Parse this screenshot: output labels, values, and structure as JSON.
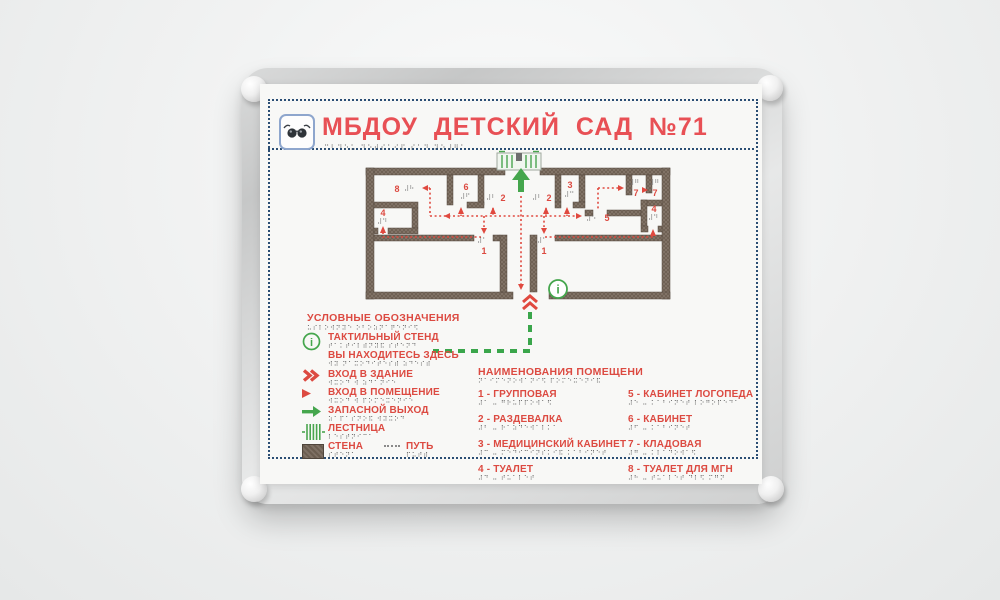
{
  "sign": {
    "title": "МБДОУ ДЕТСКИЙ САД №71",
    "title_braille": "⠍⠃⠙⠕⠥ ⠙⠑⠞⠎⠅⠊⠯ ⠎⠁⠙ ⠝⠕⠼⠛⠁"
  },
  "plan": {
    "info_symbol": "i",
    "marks": {
      "m8": {
        "num": "8",
        "braille": "⠼⠓"
      },
      "m6": {
        "num": "6",
        "braille": "⠼⠋"
      },
      "m2l": {
        "num": "2",
        "braille": "⠼⠃"
      },
      "m2r": {
        "num": "2",
        "braille": "⠼⠃"
      },
      "m3": {
        "num": "3",
        "braille": "⠼⠉"
      },
      "m7a": {
        "num": "7",
        "braille": "⠼⠛"
      },
      "m7b": {
        "num": "7",
        "braille": "⠼⠛"
      },
      "m4l": {
        "num": "4",
        "braille": "⠼⠙"
      },
      "m4r": {
        "num": "4",
        "braille": "⠼⠙"
      },
      "m5": {
        "num": "5",
        "braille": "⠼⠑"
      },
      "m1l": {
        "num": "1",
        "braille": "⠼⠁"
      },
      "m1r": {
        "num": "1",
        "braille": "⠼⠁"
      }
    }
  },
  "legend": {
    "title": "УСЛОВНЫЕ ОБОЗНАЧЕНИЯ",
    "title_braille": "⠥⠎⠇⠕⠺⠝⠽⠑ ⠕⠃⠕⠵⠝⠁⠟⠑⠝⠊⠫",
    "items": [
      {
        "icon": "info-circle",
        "label": "ТАКТИЛЬНЫЙ СТЕНД",
        "braille": "⠞⠁⠅⠞⠊⠇⠾⠝⠽⠯ ⠎⠞⠑⠝⠙"
      },
      {
        "icon": "",
        "label": "ВЫ НАХОДИТЕСЬ ЗДЕСЬ",
        "braille": "⠺⠽ ⠝⠁⠭⠕⠙⠊⠞⠑⠎⠾ ⠵⠙⠑⠎⠾"
      },
      {
        "icon": "double-chevron",
        "label": "ВХОД В ЗДАНИЕ",
        "braille": "⠺⠭⠕⠙ ⠺ ⠵⠙⠁⠝⠊⠑"
      },
      {
        "icon": "arrowhead",
        "label": "ВХОД В ПОМЕЩЕНИЕ",
        "braille": "⠺⠭⠕⠙ ⠺ ⠏⠕⠍⠑⠭⠑⠝⠊⠑"
      },
      {
        "icon": "green-arrow",
        "label": "ЗАПАСНОЙ ВЫХОД",
        "braille": "⠵⠁⠏⠁⠎⠝⠕⠯ ⠺⠽⠭⠕⠙"
      },
      {
        "icon": "stairs",
        "label": "ЛЕСТНИЦА",
        "braille": "⠇⠑⠎⠞⠝⠊⠉⠁"
      },
      {
        "icon": "wall",
        "label": "СТЕНА",
        "braille": "⠎⠞⠑⠝⠁"
      },
      {
        "icon": "path-dashes",
        "label": "ПУТЬ",
        "braille": "⠏⠥⠞⠾"
      }
    ]
  },
  "rooms": {
    "title": "НАИМЕНОВАНИЯ ПОМЕЩЕНИ",
    "title_braille": "⠝⠁⠊⠍⠑⠝⠕⠺⠁⠝⠊⠫ ⠏⠕⠍⠑⠭⠑⠝⠊⠯",
    "col1": [
      {
        "label": "1 - ГРУППОВАЯ",
        "braille": "⠼⠁ ⠤ ⠛⠗⠥⠏⠏⠕⠺⠁⠫"
      },
      {
        "label": "2 - РАЗДЕВАЛКА",
        "braille": "⠼⠃ ⠤ ⠗⠁⠵⠙⠑⠺⠁⠇⠅⠁"
      },
      {
        "label": "3 - МЕДИЦИНСКИЙ КАБИНЕТ",
        "braille": "⠼⠉ ⠤ ⠍⠑⠙⠊⠉⠊⠝⠎⠅⠊⠯ ⠅⠁⠃⠊⠝⠑⠞"
      },
      {
        "label": "4 - ТУАЛЕТ",
        "braille": "⠼⠙ ⠤ ⠞⠥⠁⠇⠑⠞"
      }
    ],
    "col2": [
      {
        "label": "5 - КАБИНЕТ ЛОГОПЕДА",
        "braille": "⠼⠑ ⠤ ⠅⠁⠃⠊⠝⠑⠞ ⠇⠕⠛⠕⠏⠑⠙⠁"
      },
      {
        "label": "6 - КАБИНЕТ",
        "braille": "⠼⠋ ⠤ ⠅⠁⠃⠊⠝⠑⠞"
      },
      {
        "label": "7 - КЛАДОВАЯ",
        "braille": "⠼⠛ ⠤ ⠅⠇⠁⠙⠕⠺⠁⠫"
      },
      {
        "label": "8 - ТУАЛЕТ ДЛЯ МГН",
        "braille": "⠼⠓ ⠤ ⠞⠥⠁⠇⠑⠞ ⠙⠇⠫ ⠍⠛⠝"
      }
    ]
  },
  "colors": {
    "accent_red": "#dc4a41",
    "title_red": "#e85055",
    "green": "#3aa64b",
    "wall_brown": "#6b5d50",
    "border_navy": "#2b4e74"
  }
}
